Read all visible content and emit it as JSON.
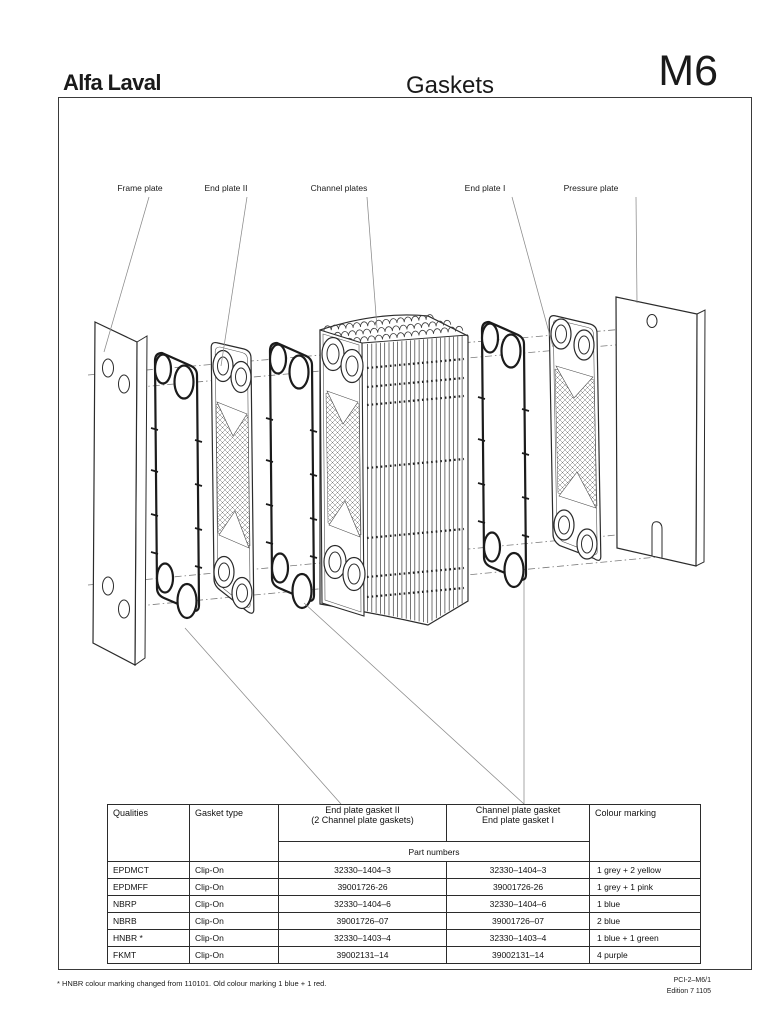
{
  "header": {
    "logo": "Alfa Laval",
    "title": "Gaskets",
    "model": "M6"
  },
  "diagram": {
    "labels": {
      "frame_plate": "Frame plate",
      "end_plate_ii": "End plate II",
      "channel_plates": "Channel plates",
      "end_plate_i": "End plate I",
      "pressure_plate": "Pressure plate"
    }
  },
  "table": {
    "headers": {
      "qualities": "Qualities",
      "gasket_type": "Gasket type",
      "end_plate_gasket_ii_line1": "End plate gasket II",
      "end_plate_gasket_ii_line2": "(2 Channel plate gaskets)",
      "channel_plate_gasket_line1": "Channel plate gasket",
      "channel_plate_gasket_line2": "End plate gasket I",
      "colour_marking": "Colour marking",
      "part_numbers": "Part numbers"
    },
    "rows": [
      {
        "quality": "EPDMCT",
        "gasket_type": "Clip-On",
        "part_end_plate_ii": "32330–1404–3",
        "part_channel_end_i": "32330–1404–3",
        "colour_marking": "1 grey + 2 yellow"
      },
      {
        "quality": "EPDMFF",
        "gasket_type": "Clip-On",
        "part_end_plate_ii": "39001726-26",
        "part_channel_end_i": "39001726-26",
        "colour_marking": "1 grey + 1 pink"
      },
      {
        "quality": "NBRP",
        "gasket_type": "Clip-On",
        "part_end_plate_ii": "32330–1404–6",
        "part_channel_end_i": "32330–1404–6",
        "colour_marking": "1 blue"
      },
      {
        "quality": "NBRB",
        "gasket_type": "Clip-On",
        "part_end_plate_ii": "39001726–07",
        "part_channel_end_i": "39001726–07",
        "colour_marking": "2 blue"
      },
      {
        "quality": "HNBR *",
        "gasket_type": "Clip-On",
        "part_end_plate_ii": "32330–1403–4",
        "part_channel_end_i": "32330–1403–4",
        "colour_marking": "1 blue + 1 green"
      },
      {
        "quality": "FKMT",
        "gasket_type": "Clip-On",
        "part_end_plate_ii": "39002131–14",
        "part_channel_end_i": "39002131–14",
        "colour_marking": "4 purple"
      }
    ]
  },
  "footer": {
    "footnote": "* HNBR colour marking changed from 110101. Old colour marking 1 blue + 1 red.",
    "doc_ref": "PCI-2–M6/1",
    "edition": "Edition 7 1105"
  },
  "colors": {
    "ink": "#1a1a1a",
    "line_art": "#2b2b2b",
    "leader_line": "#8a8a8a",
    "background": "#ffffff"
  }
}
